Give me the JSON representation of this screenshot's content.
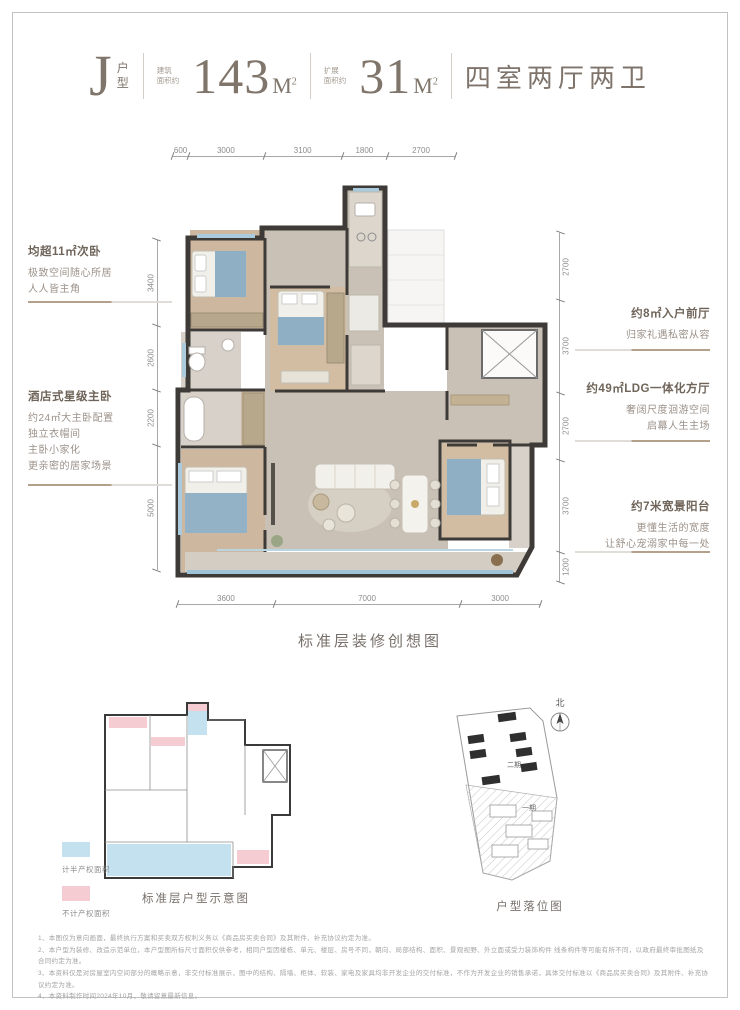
{
  "header": {
    "title_letter": "J",
    "title_suffix_l1": "户",
    "title_suffix_l2": "型",
    "area1_label_l1": "建筑",
    "area1_label_l2": "面积约",
    "area1_value": "143",
    "area2_label_l1": "扩展",
    "area2_label_l2": "面积约",
    "area2_value": "31",
    "unit": "M",
    "unit_sup": "2",
    "rooms_text": "四室两厅两卫"
  },
  "annotations": {
    "left": [
      {
        "title": "均超11㎡次卧",
        "lines": [
          "极致空间随心所居",
          "人人皆主角"
        ]
      },
      {
        "title": "酒店式星级主卧",
        "lines": [
          "约24㎡大主卧配置",
          "独立衣帽间",
          "主卧小家化",
          "更亲密的居家场景"
        ]
      }
    ],
    "right": [
      {
        "title": "约8㎡入户前厅",
        "lines": [
          "归家礼遇私密从容"
        ]
      },
      {
        "title": "约49㎡LDG一体化方厅",
        "lines": [
          "奢阔尺度洄游空间",
          "启幕人生主场"
        ]
      },
      {
        "title": "约7米宽景阳台",
        "lines": [
          "更懂生活的宽度",
          "让舒心宠溺家中每一处"
        ]
      }
    ]
  },
  "dimensions": {
    "top": [
      "600",
      "3000",
      "3100",
      "1800",
      "2700"
    ],
    "bottom": [
      "3600",
      "7000",
      "3000"
    ],
    "left": [
      "3400",
      "2600",
      "2200",
      "5000"
    ],
    "right": [
      "2700",
      "3700",
      "2700",
      "3700",
      "1200"
    ]
  },
  "captions": {
    "main_plan": "标准层装修创想图",
    "mini_plan": "标准层户型示意图",
    "site_plan": "户型落位图"
  },
  "legend": {
    "half_area": {
      "color": "#c3e1ef",
      "label": "计半产权面积"
    },
    "excluded_area": {
      "color": "#f6ccd3",
      "label": "不计产权面积"
    }
  },
  "site_plan": {
    "north_label": "北",
    "phase1_label": "一期",
    "phase2_label": "二期"
  },
  "disclaimer": [
    "1、本图仅为意向画面，最终执行方案和买卖双方权利义务以《商品房买卖合同》及其附件、补充协议约定为准。",
    "2、本户型为装修、改造示范单位，本户型图所标尺寸面积仅供参考，相同户型因楼栋、单元、楼层、房号不同，朝向、局部结构、面积、景观视野、外立面或受力装饰构件 线条构件等可能有所不同，以政府最终审批图纸及合同约定为准。",
    "3、本资料仅是对房屋室内空间部分的概略示意，非交付标准展示，图中的结构、隔墙、柜体、软装、家电及家具均非开发企业的交付标准，不作为开发企业的销售承诺，具体交付标准以《商品房买卖合同》及其附件、补充协议约定为准。",
    "4、本资料制作时间2024年10月，敬请留意最新信息。"
  ],
  "colors": {
    "accent_taupe": "#b3a18c",
    "wall": "#3d3a37",
    "wood_floor": "#cdb79e",
    "gray_floor": "#c9c1b6",
    "window_blue": "#a9cbdd",
    "legend_blue": "#c3e1ef",
    "legend_pink": "#f6ccd3"
  }
}
